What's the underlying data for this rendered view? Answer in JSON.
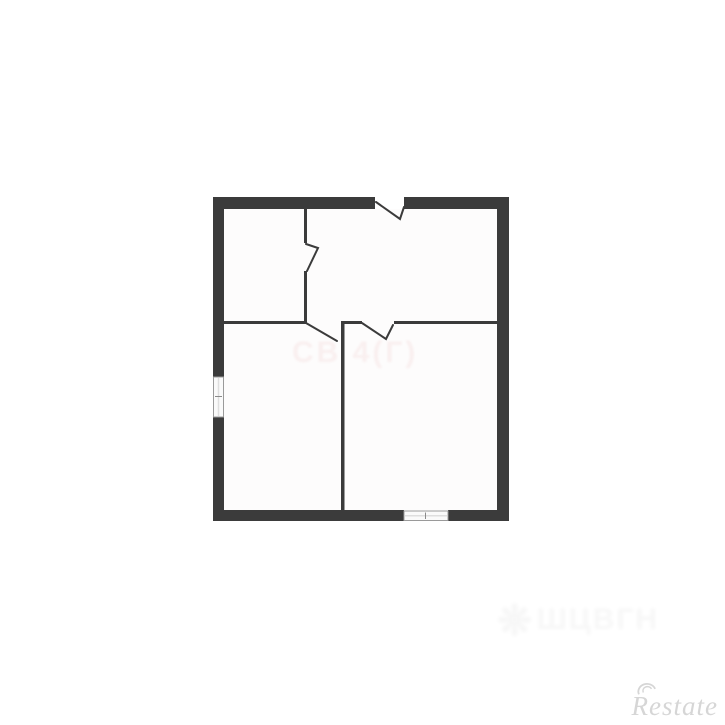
{
  "colors": {
    "background": "#ffffff",
    "wall": "#3b3b3b",
    "room_fill": "#fdfcfc",
    "window_frame": "#9a9a9a",
    "window_inner": "#dedede",
    "window_fill": "#fafafa",
    "restate_gray": "#d6d6d6",
    "faint_pink": "#d98585"
  },
  "watermarks": {
    "restate": "Restate",
    "center_faint": "СВ 4(Г)",
    "bottom_faint_logo": "❋",
    "bottom_faint": "ШЦВГН"
  },
  "floorplan": {
    "rooms": [
      "top-left-room",
      "top-right-room",
      "bottom-left-room",
      "bottom-right-room"
    ],
    "openings": [
      "door-in-top-wall",
      "door-in-upper-interior-wall",
      "door-middle-left",
      "door-middle-right",
      "window-in-left-wall",
      "window-in-bottom-wall"
    ]
  }
}
